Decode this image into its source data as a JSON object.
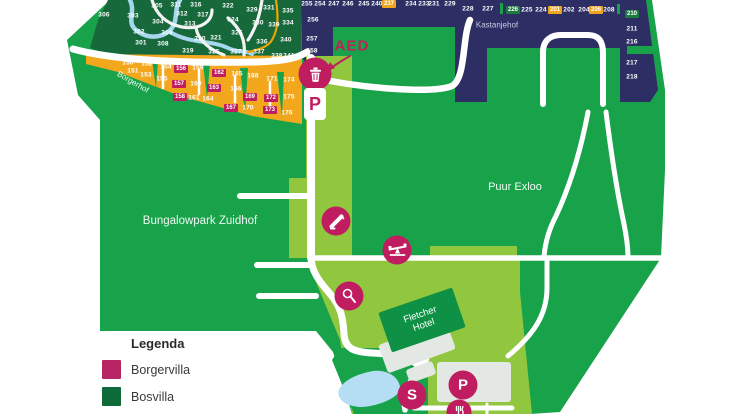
{
  "labels": {
    "park": "Bungalowpark Zuidhof",
    "puur": "Puur Exloo",
    "kastanjehof": "Kastanjehof",
    "borgerhof": "Borgerhof",
    "hotel_line1": "Fletcher",
    "hotel_line2": "Hotel",
    "aed": "AED"
  },
  "icons": {
    "s_label": "S",
    "p_label": "P",
    "p_badge": "P"
  },
  "legend": {
    "title": "Legenda",
    "items": [
      {
        "label": "Borgervilla",
        "color": "#b82563"
      },
      {
        "label": "Bosvilla",
        "color": "#0c6b38"
      }
    ]
  },
  "plots": {
    "forest": [
      {
        "n": "306",
        "x": 104,
        "y": 15
      },
      {
        "n": "303",
        "x": 133,
        "y": 16
      },
      {
        "n": "305",
        "x": 157,
        "y": 6
      },
      {
        "n": "311",
        "x": 176,
        "y": 5
      },
      {
        "n": "316",
        "x": 196,
        "y": 5
      },
      {
        "n": "322",
        "x": 228,
        "y": 6
      },
      {
        "n": "329",
        "x": 252,
        "y": 10
      },
      {
        "n": "331",
        "x": 269,
        "y": 8
      },
      {
        "n": "335",
        "x": 288,
        "y": 11
      },
      {
        "n": "304",
        "x": 158,
        "y": 22
      },
      {
        "n": "312",
        "x": 182,
        "y": 14
      },
      {
        "n": "317",
        "x": 203,
        "y": 15
      },
      {
        "n": "324",
        "x": 233,
        "y": 20
      },
      {
        "n": "330",
        "x": 258,
        "y": 23
      },
      {
        "n": "334",
        "x": 288,
        "y": 23
      },
      {
        "n": "339",
        "x": 274,
        "y": 25
      },
      {
        "n": "302",
        "x": 139,
        "y": 32
      },
      {
        "n": "309",
        "x": 167,
        "y": 33
      },
      {
        "n": "313",
        "x": 190,
        "y": 24
      },
      {
        "n": "320",
        "x": 200,
        "y": 39
      },
      {
        "n": "321",
        "x": 216,
        "y": 38
      },
      {
        "n": "326",
        "x": 237,
        "y": 33
      },
      {
        "n": "336",
        "x": 262,
        "y": 42
      },
      {
        "n": "340",
        "x": 286,
        "y": 40
      },
      {
        "n": "301",
        "x": 141,
        "y": 43
      },
      {
        "n": "308",
        "x": 163,
        "y": 44
      },
      {
        "n": "319",
        "x": 188,
        "y": 51
      },
      {
        "n": "325",
        "x": 214,
        "y": 52
      },
      {
        "n": "327",
        "x": 236,
        "y": 52
      },
      {
        "n": "337",
        "x": 259,
        "y": 52
      },
      {
        "n": "338",
        "x": 277,
        "y": 56
      },
      {
        "n": "341",
        "x": 289,
        "y": 56
      }
    ],
    "borgerhof_plain": [
      {
        "n": "150",
        "x": 128,
        "y": 63
      },
      {
        "n": "151",
        "x": 133,
        "y": 71
      },
      {
        "n": "152",
        "x": 147,
        "y": 64
      },
      {
        "n": "153",
        "x": 146,
        "y": 75
      },
      {
        "n": "154",
        "x": 166,
        "y": 67
      },
      {
        "n": "155",
        "x": 162,
        "y": 79
      },
      {
        "n": "159",
        "x": 198,
        "y": 68
      },
      {
        "n": "160",
        "x": 196,
        "y": 84
      },
      {
        "n": "161",
        "x": 194,
        "y": 98
      },
      {
        "n": "164",
        "x": 208,
        "y": 99
      },
      {
        "n": "165",
        "x": 237,
        "y": 74
      },
      {
        "n": "166",
        "x": 236,
        "y": 89
      },
      {
        "n": "168",
        "x": 253,
        "y": 76
      },
      {
        "n": "170",
        "x": 248,
        "y": 108
      },
      {
        "n": "171",
        "x": 272,
        "y": 79
      },
      {
        "n": "174",
        "x": 289,
        "y": 80
      },
      {
        "n": "175",
        "x": 289,
        "y": 97
      },
      {
        "n": "176",
        "x": 287,
        "y": 113
      }
    ],
    "borgerhof_villa": [
      {
        "n": "156",
        "x": 181,
        "y": 69
      },
      {
        "n": "157",
        "x": 179,
        "y": 84
      },
      {
        "n": "158",
        "x": 180,
        "y": 97
      },
      {
        "n": "162",
        "x": 219,
        "y": 73
      },
      {
        "n": "163",
        "x": 214,
        "y": 88
      },
      {
        "n": "167",
        "x": 231,
        "y": 108
      },
      {
        "n": "169",
        "x": 250,
        "y": 97
      },
      {
        "n": "172",
        "x": 271,
        "y": 98
      },
      {
        "n": "173",
        "x": 270,
        "y": 110
      }
    ],
    "kastanjehof": [
      {
        "n": "255",
        "x": 307,
        "y": 4
      },
      {
        "n": "254",
        "x": 320,
        "y": 4
      },
      {
        "n": "247",
        "x": 334,
        "y": 4
      },
      {
        "n": "246",
        "x": 348,
        "y": 4
      },
      {
        "n": "245",
        "x": 364,
        "y": 4
      },
      {
        "n": "240",
        "x": 377,
        "y": 4
      },
      {
        "n": "234",
        "x": 411,
        "y": 4
      },
      {
        "n": "233",
        "x": 424,
        "y": 4
      },
      {
        "n": "231",
        "x": 434,
        "y": 4
      },
      {
        "n": "229",
        "x": 450,
        "y": 4
      },
      {
        "n": "228",
        "x": 468,
        "y": 9
      },
      {
        "n": "227",
        "x": 488,
        "y": 9
      },
      {
        "n": "225",
        "x": 527,
        "y": 10
      },
      {
        "n": "224",
        "x": 541,
        "y": 10
      },
      {
        "n": "202",
        "x": 569,
        "y": 10
      },
      {
        "n": "204",
        "x": 584,
        "y": 10
      },
      {
        "n": "208",
        "x": 609,
        "y": 10
      },
      {
        "n": "256",
        "x": 313,
        "y": 20
      },
      {
        "n": "257",
        "x": 312,
        "y": 39
      },
      {
        "n": "258",
        "x": 312,
        "y": 51
      },
      {
        "n": "211",
        "x": 632,
        "y": 29
      },
      {
        "n": "216",
        "x": 632,
        "y": 42
      },
      {
        "n": "217",
        "x": 632,
        "y": 63
      },
      {
        "n": "218",
        "x": 632,
        "y": 77
      }
    ],
    "kastanjehof_green": [
      {
        "n": "226",
        "x": 513,
        "y": 10
      },
      {
        "n": "210",
        "x": 632,
        "y": 14
      }
    ],
    "kastanjehof_orange": [
      {
        "n": "237",
        "x": 389,
        "y": 4
      },
      {
        "n": "201",
        "x": 555,
        "y": 10
      },
      {
        "n": "206",
        "x": 596,
        "y": 10
      }
    ]
  }
}
